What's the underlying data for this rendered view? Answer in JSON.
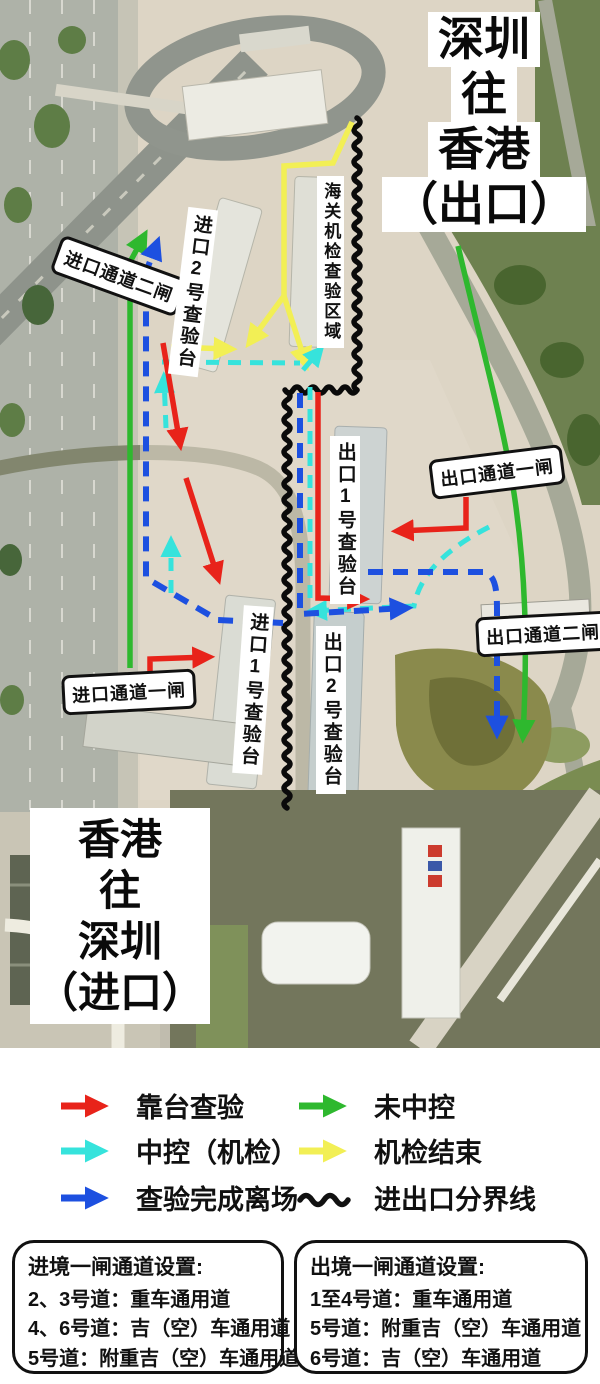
{
  "map": {
    "exit_direction": {
      "lines": [
        "深圳",
        "往",
        "香港",
        "（出口）"
      ]
    },
    "entry_direction": {
      "lines": [
        "香港",
        "往",
        "深圳",
        "（进口）"
      ]
    },
    "gates": {
      "import_gate2": "进口通道二闸",
      "import_gate1": "进口通道一闸",
      "export_gate1": "出口通道一闸",
      "export_gate2": "出口通道二闸"
    },
    "stations": {
      "import_booth2": "进口2号查验台",
      "import_booth1": "进口1号查验台",
      "export_booth1": "出口1号查验台",
      "export_booth2": "出口2号查验台",
      "customs_machine_area": "海关机检查验区域"
    }
  },
  "legend": {
    "items": [
      {
        "label": "靠台查验",
        "color": "#e8231a",
        "style": "arrow"
      },
      {
        "label": "中控（机检）",
        "color": "#36e3dc",
        "style": "arrow"
      },
      {
        "label": "查验完成离场",
        "color": "#1d50e0",
        "style": "arrow"
      },
      {
        "label": "未中控",
        "color": "#2eb82e",
        "style": "arrow"
      },
      {
        "label": "机检结束",
        "color": "#f2ef55",
        "style": "arrow"
      },
      {
        "label": "进出口分界线",
        "color": "#111111",
        "style": "wavy"
      }
    ]
  },
  "notes": {
    "entry_box": {
      "title": "进境一闸通道设置:",
      "lines": [
        "2、3号道：重车通用道",
        "4、6号道：吉（空）车通用道",
        "5号道：附重吉（空）车通用道"
      ]
    },
    "exit_box": {
      "title": "出境一闸通道设置:",
      "lines": [
        "1至4号道：重车通用道",
        "5号道：附重吉（空）车通用道",
        "6号道：吉（空）车通用道"
      ]
    }
  },
  "colors": {
    "dock_inspection": "#e8231a",
    "central_machine_check": "#36e3dc",
    "leave_after_inspection": "#1d50e0",
    "not_central_control": "#2eb82e",
    "machine_check_done": "#f2ef55",
    "divider": "#111111"
  }
}
